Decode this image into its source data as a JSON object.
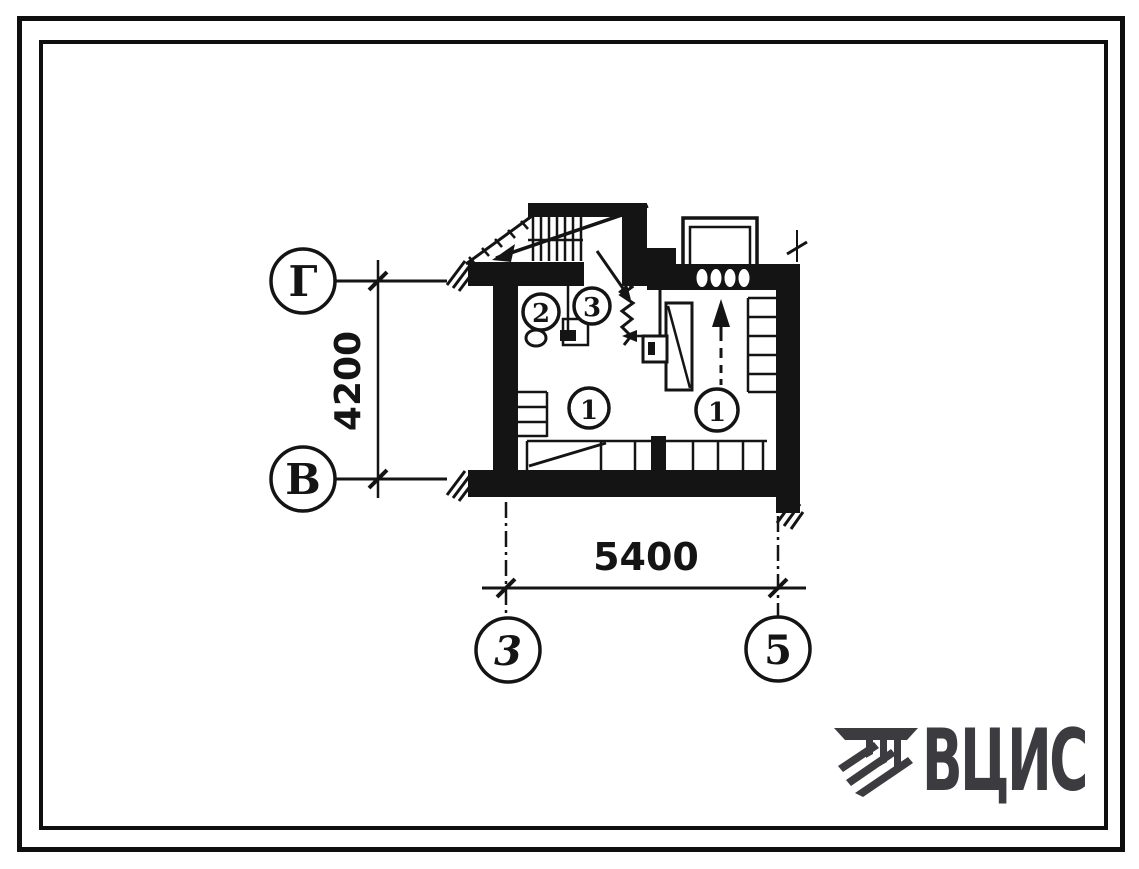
{
  "sheet": {
    "background": "#ffffff",
    "ink": "#141414"
  },
  "plan": {
    "axis_circles": {
      "row_top": "Г",
      "row_bottom": "В",
      "column_left": "3",
      "column_right": "5"
    },
    "dimensions": {
      "vertical": "4200",
      "horizontal": "5400"
    },
    "room_labels": {
      "room2": "2",
      "room3": "3",
      "room1_left": "1",
      "room1_right": "1"
    }
  },
  "logo": {
    "text": "ВЦИС",
    "color": "#3b3b40",
    "icon": "hatched-capital-icon"
  }
}
